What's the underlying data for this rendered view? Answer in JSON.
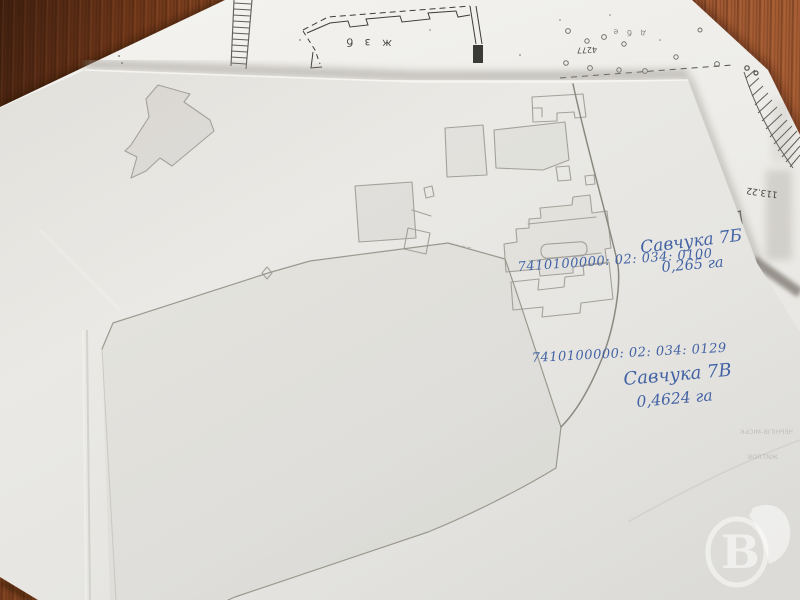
{
  "handwritten_annotations": {
    "ink_color": "#35589f",
    "parcel_a": {
      "cadastral_number": "7410100000: 02: 034: 0100",
      "name": "Савчука 7Б",
      "area": "0,265 га"
    },
    "parcel_b": {
      "cadastral_number": "7410100000: 02: 034: 0129",
      "name": "Савчука 7В",
      "area": "0,4624 га"
    }
  },
  "printed_sheet": {
    "building_label": "ж з б",
    "mark_4277": "4277",
    "elevation_113_22": "113.22",
    "corner_note": "д б е"
  },
  "showthrough": {
    "line1": "ЧЕРНІГІВ-МІСЬК",
    "line2": "ЖИТЛОВ"
  },
  "watermark": {
    "letter": "В"
  },
  "colors": {
    "desk": "#7d3f1e",
    "paper_front": "#e7e6e2",
    "paper_top": "#f2f1ee",
    "pencil": "#a3a199",
    "ink": "#35589f"
  }
}
